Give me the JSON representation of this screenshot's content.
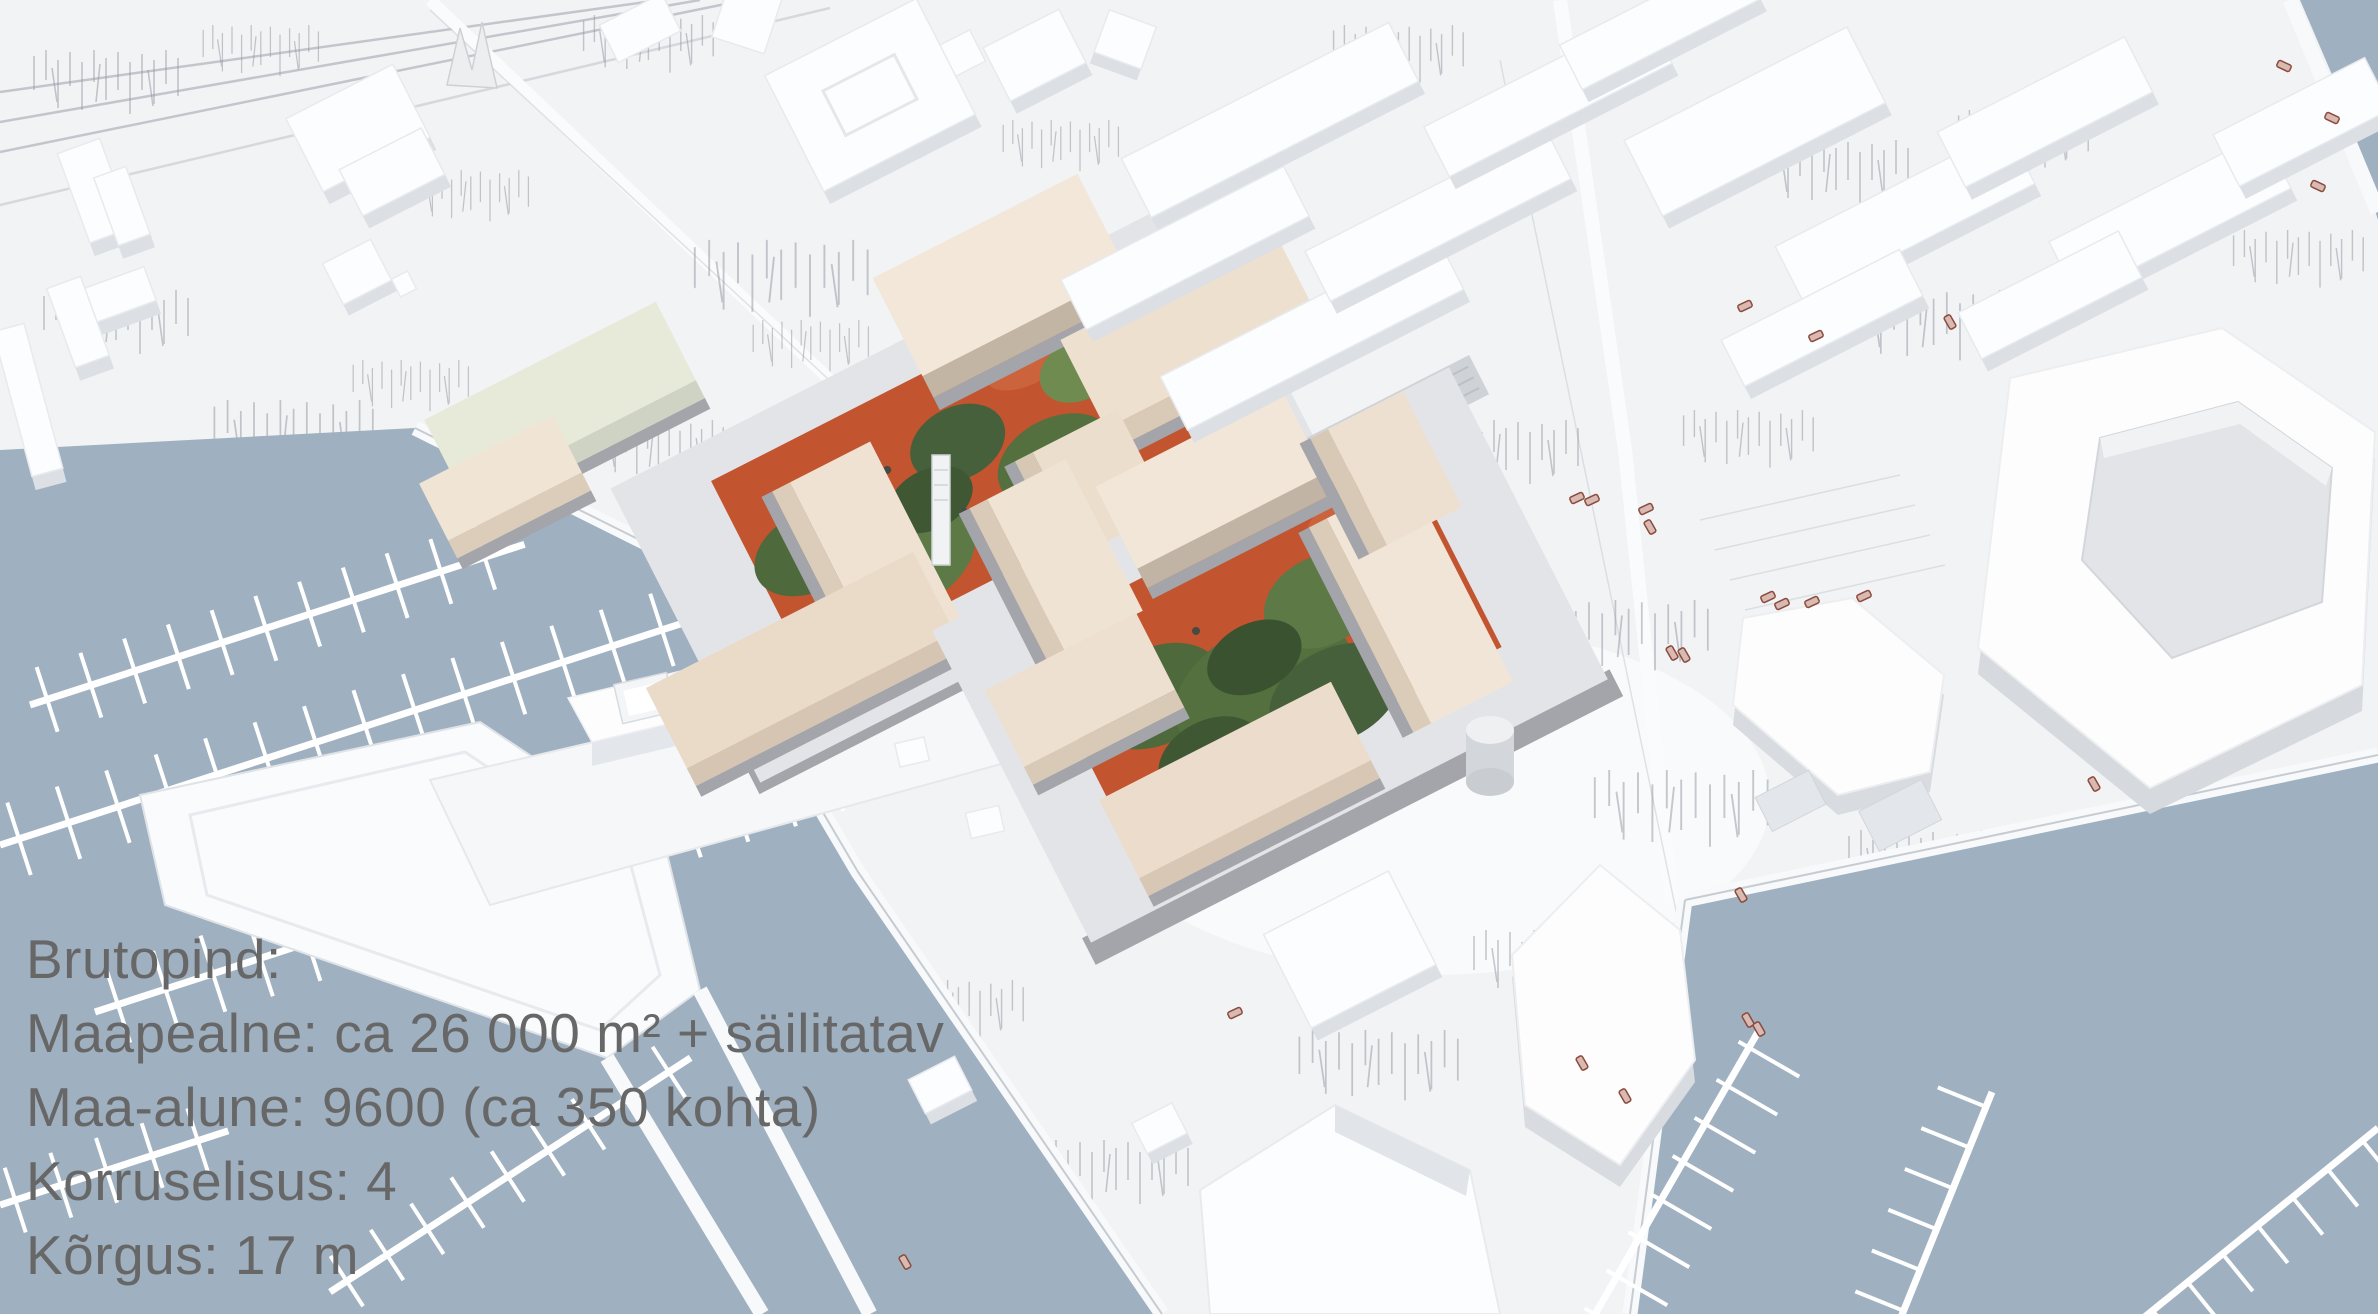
{
  "overlay": {
    "lines": [
      "Brutopind:",
      "Maapealne: ca 26 000 m² + säilitatav",
      "Maa-alune: 9600 (ca 350 kohta)",
      "Korruselisus: 4",
      "Kõrgus: 17 m"
    ]
  },
  "palette": {
    "ground": "#f2f3f5",
    "water": "#9fb0c1",
    "building_white_top": "#fcfdfe",
    "building_white_face": "#dcdfe3",
    "development_beige": "#efe3d3",
    "development_base_grey": "#a3a5aa",
    "courtyard_terracotta": "#c2542f",
    "courtyard_green": "#53703e",
    "boat_outline_red": "#8a4a3c",
    "text_grey": "#676767"
  }
}
